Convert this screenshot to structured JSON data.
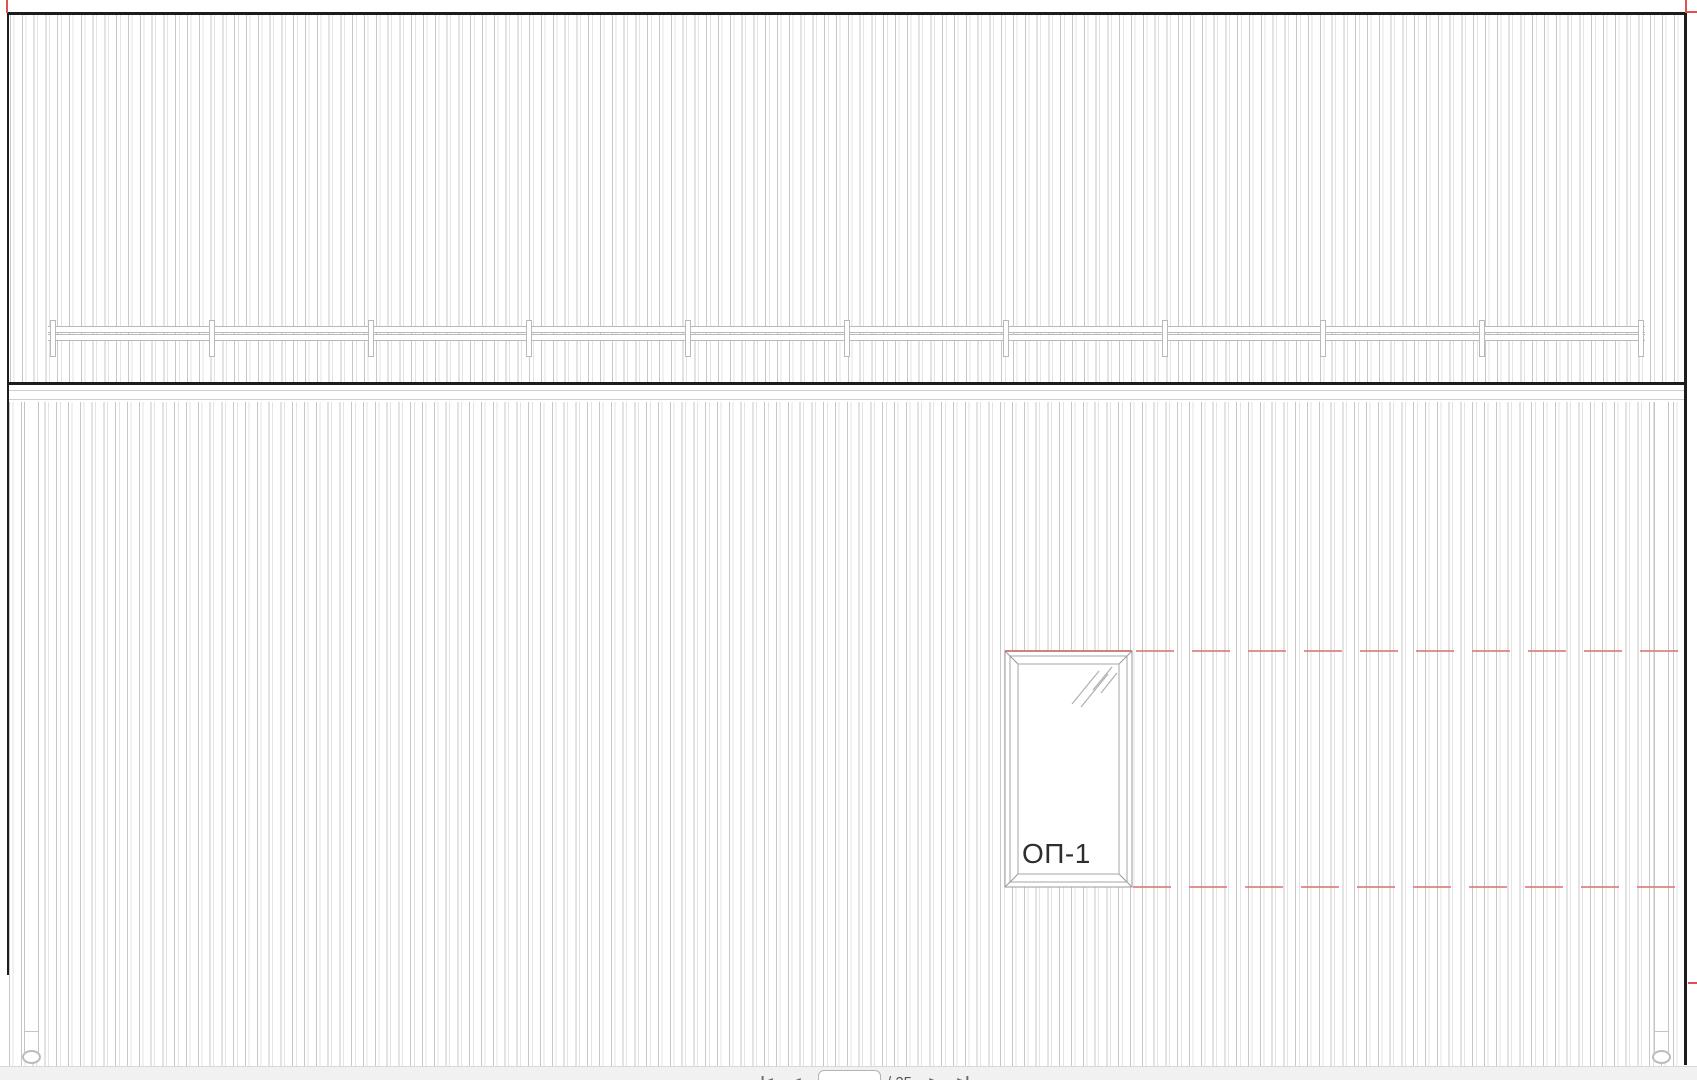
{
  "drawing": {
    "type": "building-elevation",
    "window": {
      "label": "ОП-1",
      "glazing_symbol": "diagonal-glass-slashes"
    },
    "railing": {
      "posts": 11
    },
    "markup": {
      "dash_color": "#d8827b",
      "tick_color": "#e05252",
      "reference_lines": 2
    }
  },
  "pager": {
    "first_label": "|<",
    "prev_label": "<",
    "current_page": "11",
    "separator_total": "/ 25",
    "next_label": ">",
    "last_label": ">|"
  }
}
